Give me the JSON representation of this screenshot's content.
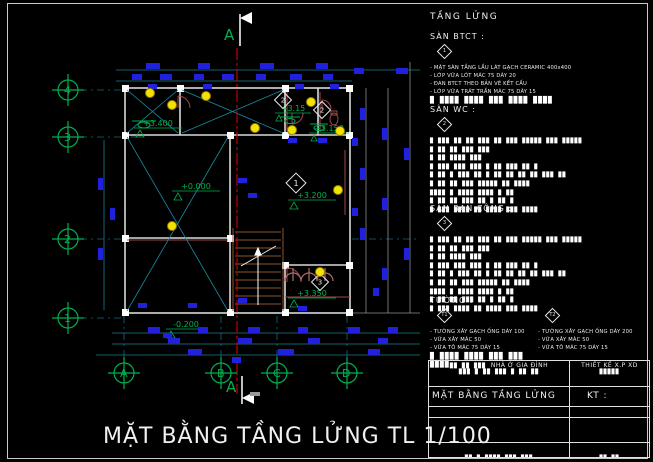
{
  "drawing_title": "MẶT BẰNG TẦNG LỬNG TL 1/100",
  "section_label": "A",
  "axes": {
    "rows": [
      "4",
      "3",
      "2",
      "1"
    ],
    "cols": [
      "A",
      "B",
      "C",
      "D"
    ]
  },
  "levels": [
    "+3.400",
    "+3.15",
    "+3.150",
    "+0.000",
    "+3.200",
    "+3.350",
    "-0.200"
  ],
  "notes": {
    "heading": "TẦNG LỬNG",
    "btct": {
      "label": "SÀN BTCT :",
      "marker": "1",
      "lines": [
        "- MẶT SÀN TẦNG LẦU LÁT GẠCH CERAMIC 400x400",
        "- LỚP VỮA LÓT MÁC 75 DÀY 20",
        "- ĐAN BTCT THEO BẢN VẼ KẾT CẤU",
        "- LỚP VỮA TRÁT TRẦN MÁC 75 DÀY 15"
      ],
      "bar": "█ ████ ████ ███ ████ ████"
    },
    "wc": {
      "label": "SÀN WC :",
      "marker": "2",
      "block_lines": [
        "█ ███ ██ ██ ███ ██ ███ █████ ███ █████",
        "█ ██ ██ ███ ███",
        "█ ██ ████ ███",
        "█ ███ ███ ███ █ ██ ███ ██ █",
        "█ ██ █ ███ ██ █ ██ ██ ██ ██ ███ ██",
        "█ ██ ██ ███ █████ ██ ████",
        "   ████ █ ████ ████ █ ██",
        "█ ██ ██ ███ ██ █ ██ █",
        "█ ███ ████ ██ ████ ███ ████"
      ]
    },
    "bancong": {
      "label": "SÀN BAN CÔNG :",
      "marker": "3",
      "block_lines": [
        "█ ███ ██ ██ ███ ██ ███ █████ ███ █████",
        "█ ██ ██ ███ ███",
        "█ ██ ████ ███",
        "█ ███ ███ ███ █ ██ ███ ██ █",
        "█ ██ █ ███ ██ █ ██ ██ ██ ██ ███ ██",
        "█ ██ ██ ███ █████ ██ ████",
        "   ████ █ ████ ████ █ ██",
        "█ ██ ██ ███ ██ █ ██ █",
        "█ ███ ████ ██ ████ ███ ████"
      ]
    },
    "walls": {
      "label": "TƯỜNG :",
      "columns": [
        {
          "marker": "T1",
          "lines": [
            "- TƯỜNG XÂY GẠCH ỐNG DÀY 100",
            "- VỮA XÂY MÁC 50",
            "- VỮA TÔ MÁC 75 DÀY 15"
          ],
          "bar": "█ ████ ████ ███ ███ ████"
        },
        {
          "marker": "T2",
          "lines": [
            "- TƯỜNG XÂY GẠCH ỐNG DÀY 200",
            "- VỮA XÂY MÁC 50",
            "- VỮA TÔ MÁC 75 DÀY 15"
          ],
          "bar": ""
        }
      ]
    }
  },
  "titleblock": {
    "project_blocks": "██ ██ ███",
    "project": "NHÀ Ở GIA ĐÌNH",
    "project_sub": "███ █ ██ ███ █ ██ ██",
    "designer": "THIẾT KẾ X.P XD",
    "designer_sub": "█████",
    "drawing_name": "MẶT BẰNG TẦNG LỬNG",
    "kt": "KT :",
    "row3_left": "███ ██ █",
    "row3_right": "██ ███",
    "row5_left": "██ █ ████ ███ ███",
    "row5_right": "██ ██"
  },
  "plan": {
    "room_markers": [
      "2",
      "2",
      "1",
      "3"
    ],
    "dimension_blocks": [
      [
        146,
        63,
        14,
        6
      ],
      [
        198,
        63,
        12,
        6
      ],
      [
        260,
        63,
        14,
        6
      ],
      [
        316,
        63,
        12,
        6
      ],
      [
        132,
        74,
        10,
        6
      ],
      [
        160,
        74,
        12,
        6
      ],
      [
        194,
        74,
        10,
        6
      ],
      [
        222,
        74,
        12,
        6
      ],
      [
        256,
        74,
        10,
        6
      ],
      [
        290,
        74,
        12,
        6
      ],
      [
        323,
        74,
        10,
        6
      ],
      [
        354,
        68,
        10,
        6
      ],
      [
        396,
        68,
        12,
        6
      ],
      [
        360,
        108,
        5,
        12
      ],
      [
        360,
        168,
        5,
        12
      ],
      [
        360,
        228,
        5,
        12
      ],
      [
        382,
        128,
        5,
        12
      ],
      [
        382,
        198,
        5,
        12
      ],
      [
        382,
        268,
        5,
        12
      ],
      [
        404,
        148,
        5,
        12
      ],
      [
        404,
        248,
        5,
        12
      ],
      [
        98,
        178,
        5,
        12
      ],
      [
        98,
        248,
        5,
        12
      ],
      [
        110,
        208,
        5,
        12
      ],
      [
        148,
        327,
        12,
        6
      ],
      [
        198,
        327,
        10,
        6
      ],
      [
        248,
        327,
        12,
        6
      ],
      [
        298,
        327,
        10,
        6
      ],
      [
        348,
        327,
        12,
        6
      ],
      [
        388,
        327,
        10,
        6
      ],
      [
        168,
        338,
        12,
        6
      ],
      [
        238,
        338,
        14,
        6
      ],
      [
        308,
        338,
        12,
        6
      ],
      [
        378,
        338,
        10,
        6
      ],
      [
        188,
        349,
        14,
        6
      ],
      [
        278,
        349,
        16,
        6
      ],
      [
        368,
        349,
        12,
        6
      ],
      [
        148,
        84,
        9,
        5
      ],
      [
        203,
        84,
        9,
        5
      ],
      [
        295,
        84,
        9,
        5
      ],
      [
        330,
        84,
        9,
        5
      ],
      [
        352,
        138,
        6,
        8
      ],
      [
        352,
        208,
        6,
        8
      ],
      [
        238,
        178,
        9,
        5
      ],
      [
        248,
        193,
        9,
        5
      ],
      [
        288,
        138,
        9,
        5
      ],
      [
        318,
        138,
        9,
        5
      ],
      [
        238,
        298,
        9,
        5
      ],
      [
        298,
        306,
        9,
        5
      ],
      [
        138,
        303,
        9,
        5
      ],
      [
        188,
        303,
        9,
        5
      ],
      [
        163,
        333,
        9,
        5
      ],
      [
        232,
        357,
        9,
        6
      ],
      [
        373,
        288,
        6,
        8
      ]
    ],
    "lights": [
      [
        150,
        93
      ],
      [
        172,
        105
      ],
      [
        206,
        96
      ],
      [
        311,
        102
      ],
      [
        292,
        130
      ],
      [
        255,
        128
      ],
      [
        338,
        190
      ],
      [
        172,
        226
      ],
      [
        320,
        272
      ],
      [
        340,
        131
      ]
    ]
  }
}
